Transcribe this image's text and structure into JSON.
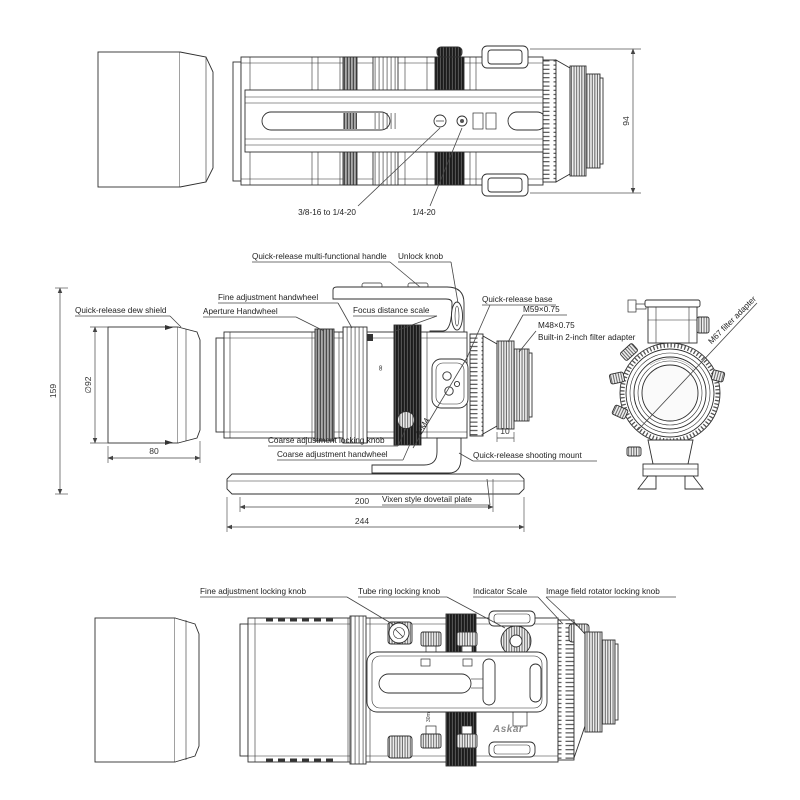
{
  "drawing_title": "Telescope technical diagram",
  "brand": "Askar",
  "views": {
    "top": {
      "labels": {
        "thread_38": "3/8-16 to 1/4-20",
        "thread_14": "1/4-20"
      },
      "dims": {
        "height": "94"
      }
    },
    "side": {
      "labels": {
        "handle": "Quick-release multi-functional handle",
        "unlock_knob": "Unlock knob",
        "fine_handwheel": "Fine adjustment handwheel",
        "aperture_handwheel": "Aperture Handwheel",
        "focus_scale": "Focus distance scale",
        "qr_base": "Quick-release base",
        "m59": "M59×0.75",
        "m48": "M48×0.75",
        "filter_adapter_2in": "Built-in 2-inch filter adapter",
        "dew_shield": "Quick-release dew shield",
        "coarse_lock": "Coarse adjustment locking knob",
        "coarse_handwheel": "Coarse adjustment handwheel",
        "qr_mount": "Quick-release shooting mount",
        "dovetail": "Vixen style dovetail plate",
        "thread_2m4": "2-M4",
        "m67": "M67 filter adapter"
      },
      "dims": {
        "overall_height": "159",
        "dew_diameter": "∅92",
        "dew_length": "80",
        "plate_length": "200",
        "overall_length": "244",
        "ring_width": "10"
      },
      "markings": {
        "infinity": "∞"
      }
    },
    "bottom": {
      "labels": {
        "fine_lock": "Fine adjustment locking knob",
        "tube_ring_lock": "Tube ring locking knob",
        "indicator_scale": "Indicator Scale",
        "rotator_lock": "Image field rotator locking knob"
      },
      "markings": {
        "focus_30m": "30m"
      }
    }
  },
  "colors": {
    "line": "#2f2f2f",
    "leader": "#444444",
    "knurl_dark": "#1b1b1b",
    "knurl_gray": "#a9a9a9",
    "background": "#ffffff"
  }
}
